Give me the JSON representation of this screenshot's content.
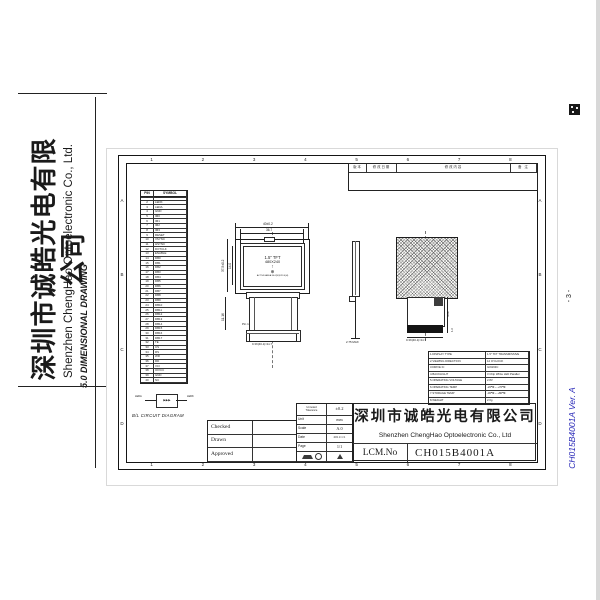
{
  "left_header": {
    "company_cn": "深圳市诚皓光电有限公司",
    "company_en": "Shenzhen ChengHao Optoelectronic Co., Ltd.",
    "section_title": "5.0  DIMENSIONAL DRAWING"
  },
  "margin": {
    "page_number": "- 3 -",
    "doc_code": "CH015B4001A  Ver. A",
    "accent_blue": "#2a2ab8"
  },
  "icons": {
    "top_right_mark": "grid-stamp-icon",
    "viewing_direction_arrow": "↑",
    "viewing_direction_circle": "⊕",
    "projection": "first-angle-projection-icon",
    "warning": "warning-triangle-icon"
  },
  "frame": {
    "numbers": [
      "1",
      "2",
      "3",
      "4",
      "5",
      "6",
      "7",
      "8"
    ],
    "letters": [
      "A",
      "B",
      "C",
      "D"
    ]
  },
  "revision_table": {
    "headers": [
      "版本",
      "修改日期",
      "修改内容",
      "备 注"
    ]
  },
  "pin_table": {
    "headers": [
      "PIN",
      "SYMBOL"
    ],
    "pins": [
      {
        "n": "1",
        "sym": "GND"
      },
      {
        "n": "2",
        "sym": "LEDK"
      },
      {
        "n": "3",
        "sym": "LEDA"
      },
      {
        "n": "4",
        "sym": "GND"
      },
      {
        "n": "5",
        "sym": "IM0"
      },
      {
        "n": "6",
        "sym": "IM1"
      },
      {
        "n": "7",
        "sym": "IM2"
      },
      {
        "n": "8",
        "sym": "IM3"
      },
      {
        "n": "9",
        "sym": "RESET"
      },
      {
        "n": "10",
        "sym": "VSYNC"
      },
      {
        "n": "11",
        "sym": "HSYNC"
      },
      {
        "n": "12",
        "sym": "DOTCLK"
      },
      {
        "n": "13",
        "sym": "ENABLE"
      },
      {
        "n": "14",
        "sym": "DB0"
      },
      {
        "n": "15",
        "sym": "DB1"
      },
      {
        "n": "16",
        "sym": "DB2"
      },
      {
        "n": "17",
        "sym": "DB3"
      },
      {
        "n": "18",
        "sym": "DB4"
      },
      {
        "n": "19",
        "sym": "DB5"
      },
      {
        "n": "20",
        "sym": "DB6"
      },
      {
        "n": "21",
        "sym": "DB7"
      },
      {
        "n": "22",
        "sym": "DB8"
      },
      {
        "n": "23",
        "sym": "DB9"
      },
      {
        "n": "24",
        "sym": "DB10"
      },
      {
        "n": "25",
        "sym": "DB11"
      },
      {
        "n": "26",
        "sym": "DB12"
      },
      {
        "n": "27",
        "sym": "DB13"
      },
      {
        "n": "28",
        "sym": "DB14"
      },
      {
        "n": "29",
        "sym": "DB15"
      },
      {
        "n": "30",
        "sym": "DB16"
      },
      {
        "n": "31",
        "sym": "DB17"
      },
      {
        "n": "32",
        "sym": "TE"
      },
      {
        "n": "33",
        "sym": "CS"
      },
      {
        "n": "34",
        "sym": "RS"
      },
      {
        "n": "35",
        "sym": "WR"
      },
      {
        "n": "36",
        "sym": "RD"
      },
      {
        "n": "37",
        "sym": "VCI"
      },
      {
        "n": "38",
        "sym": "IOVCC"
      },
      {
        "n": "39",
        "sym": "GND"
      },
      {
        "n": "40",
        "sym": "NC"
      }
    ]
  },
  "front_view": {
    "size_label": "1.5\" TFT",
    "resolution": "480X240",
    "aa_note": "ACTIVE AREA 30.6(W)X23.0(H)",
    "pin1_label": "Pin 1"
  },
  "dims": {
    "front_width": "40±0.2",
    "bezel_width": "36.7",
    "front_height": "37.5±0.2",
    "va_height": "14.0",
    "fpc_height": "11.16",
    "front_pitch": "0.3X(40-1)=11.7",
    "side_thickness": "2.75 MAX",
    "rear_pitch": "0.3X(40-1)=11.7",
    "rear_d1": "4.28",
    "rear_d2": "1.6"
  },
  "bl_circuit": {
    "caption": "B/L CIRCUIT DIAGRAM",
    "left_label": "LEDA",
    "right_label": "LEDK",
    "diodes": "▶▶▶"
  },
  "spec_table": {
    "rows": [
      {
        "label": "1.DISPLAY TYPE",
        "value": "1.5\" TFT TRANSMISSIVE"
      },
      {
        "label": "2.VIEWING DIRECTION",
        "value": "12 O'CLOCK"
      },
      {
        "label": "3.DRIVE IC",
        "value": "ILI9163C"
      },
      {
        "label": "4.BACKLIGHT",
        "value": "3 Chip White LED Parallel"
      },
      {
        "label": "5.OPERATING VOLTAGE",
        "value": "2.8V"
      },
      {
        "label": "6.OPERATING TEMP",
        "value": "-20℃ ~ +70℃"
      },
      {
        "label": "7.STORAGE TEMP",
        "value": "-30℃ ~ +80℃"
      },
      {
        "label": "8.WEIGHT",
        "value": "2.0g"
      }
    ]
  },
  "title_block": {
    "sign_rows": [
      "Checked",
      "Drawn",
      "Approved"
    ],
    "tolerance_label_1": "Unnoted",
    "tolerance_label_2": "Tolerance",
    "tolerance": "±0.2",
    "unit_label": "Unit",
    "unit": "mm",
    "scale_label": "Scale",
    "scale": "A.0",
    "date_label": "Date",
    "date": "2011/1/1",
    "page_label": "Page",
    "page": "1/1",
    "company_cn": "深圳市诚皓光电有限公司",
    "company_en": "Shenzhen ChengHao Optoelectronic Co., Ltd",
    "lcm_label": "LCM.No",
    "lcm_value": "CH015B4001A"
  }
}
